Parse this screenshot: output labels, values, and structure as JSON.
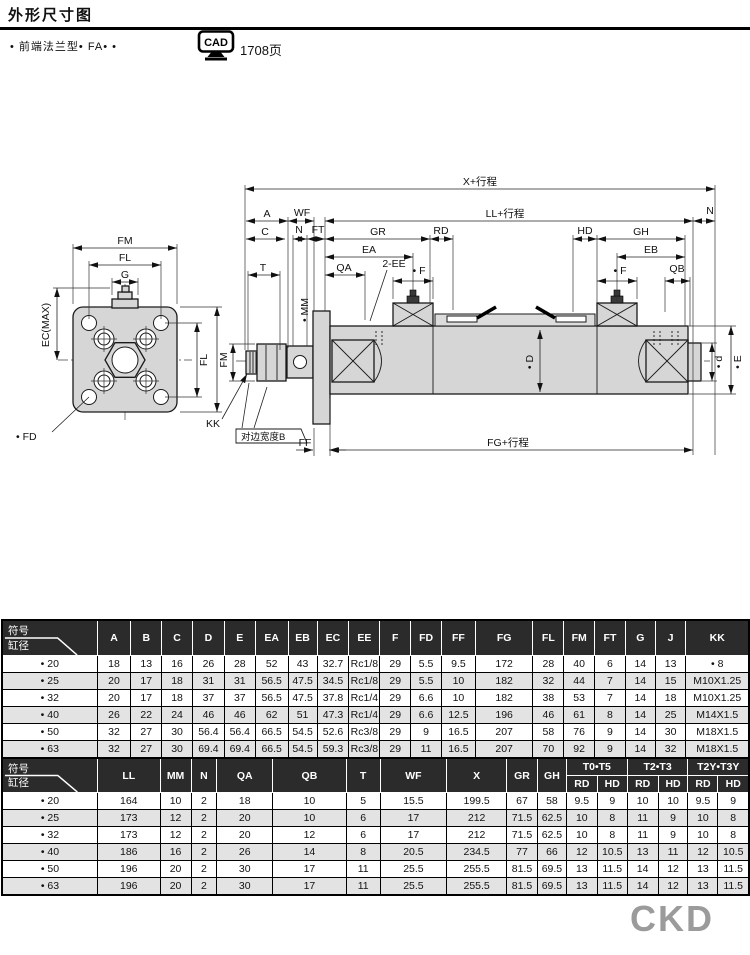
{
  "page": {
    "title": "外形尺寸图",
    "subtitle": "•  前端法兰型•  FA•  •",
    "cad_icon_label": "CAD",
    "cad_page": "1708页",
    "brand": "CKD",
    "colors": {
      "header_bg": "#2b2b2b",
      "row_alt": "#e3e3e3",
      "brand_gray": "#9b9b9b",
      "metal_fill": "#d6d6d6"
    }
  },
  "drawing": {
    "labels": {
      "x_stroke": "X+行程",
      "a": "A",
      "wf": "WF",
      "ll_stroke": "LL+行程",
      "n_right": "N",
      "c": "C",
      "n_mid": "N",
      "ft": "FT",
      "gr": "GR",
      "rd": "RD",
      "hd": "HD",
      "gh": "GH",
      "ea": "EA",
      "eb": "EB",
      "t": "T",
      "qa": "QA",
      "ee": "2-EE",
      "f_front": "• F",
      "f_rear": "• F",
      "qb": "QB",
      "fm_h": "FM",
      "fl_h": "FL",
      "g": "G",
      "ec_max": "EC(MAX)",
      "fl_v": "FL",
      "fm_v": "FM",
      "fd": "• FD",
      "kk": "KK",
      "mm": "• MM",
      "d_bore": "• D",
      "d_rod": "• d",
      "e_dim": "• E",
      "flat_b": "对边宽度B",
      "ff": "FF",
      "fg_stroke": "FG+行程"
    }
  },
  "tables": [
    {
      "corner_top": "符号",
      "corner_bottom": "缸径",
      "columns": [
        "A",
        "B",
        "C",
        "D",
        "E",
        "EA",
        "EB",
        "EC",
        "EE",
        "F",
        "FD",
        "FF",
        "FG",
        "FL",
        "FM",
        "FT",
        "G",
        "J",
        "KK"
      ],
      "rows": [
        {
          "bore": "• 20",
          "cells": [
            "18",
            "13",
            "16",
            "26",
            "28",
            "52",
            "43",
            "32.7",
            "Rc1/8",
            "29",
            "5.5",
            "9.5",
            "172",
            "28",
            "40",
            "6",
            "14",
            "13",
            "• 8"
          ]
        },
        {
          "bore": "• 25",
          "cells": [
            "20",
            "17",
            "18",
            "31",
            "31",
            "56.5",
            "47.5",
            "34.5",
            "Rc1/8",
            "29",
            "5.5",
            "10",
            "182",
            "32",
            "44",
            "7",
            "14",
            "15",
            "M10X1.25"
          ]
        },
        {
          "bore": "• 32",
          "cells": [
            "20",
            "17",
            "18",
            "37",
            "37",
            "56.5",
            "47.5",
            "37.8",
            "Rc1/4",
            "29",
            "6.6",
            "10",
            "182",
            "38",
            "53",
            "7",
            "14",
            "18",
            "M10X1.25"
          ]
        },
        {
          "bore": "• 40",
          "cells": [
            "26",
            "22",
            "24",
            "46",
            "46",
            "62",
            "51",
            "47.3",
            "Rc1/4",
            "29",
            "6.6",
            "12.5",
            "196",
            "46",
            "61",
            "8",
            "14",
            "25",
            "M14X1.5"
          ]
        },
        {
          "bore": "• 50",
          "cells": [
            "32",
            "27",
            "30",
            "56.4",
            "56.4",
            "66.5",
            "54.5",
            "52.6",
            "Rc3/8",
            "29",
            "9",
            "16.5",
            "207",
            "58",
            "76",
            "9",
            "14",
            "30",
            "M18X1.5"
          ]
        },
        {
          "bore": "• 63",
          "cells": [
            "32",
            "27",
            "30",
            "69.4",
            "69.4",
            "66.5",
            "54.5",
            "59.3",
            "Rc3/8",
            "29",
            "11",
            "16.5",
            "207",
            "70",
            "92",
            "9",
            "14",
            "32",
            "M18X1.5"
          ]
        }
      ]
    },
    {
      "corner_top": "符号",
      "corner_bottom": "缸径",
      "columns": [
        "LL",
        "MM",
        "N",
        "QA",
        "QB",
        "T",
        "WF",
        "X",
        "GR",
        "GH"
      ],
      "groups": [
        {
          "label": "T0•T5",
          "sub": [
            "RD",
            "HD"
          ]
        },
        {
          "label": "T2•T3",
          "sub": [
            "RD",
            "HD"
          ]
        },
        {
          "label": "T2Y•T3Y",
          "sub": [
            "RD",
            "HD"
          ]
        }
      ],
      "rows": [
        {
          "bore": "• 20",
          "cells": [
            "164",
            "10",
            "2",
            "18",
            "10",
            "5",
            "15.5",
            "199.5",
            "67",
            "58",
            "9.5",
            "9",
            "10",
            "10",
            "9.5",
            "9"
          ]
        },
        {
          "bore": "• 25",
          "cells": [
            "173",
            "12",
            "2",
            "20",
            "10",
            "6",
            "17",
            "212",
            "71.5",
            "62.5",
            "10",
            "8",
            "11",
            "9",
            "10",
            "8"
          ]
        },
        {
          "bore": "• 32",
          "cells": [
            "173",
            "12",
            "2",
            "20",
            "12",
            "6",
            "17",
            "212",
            "71.5",
            "62.5",
            "10",
            "8",
            "11",
            "9",
            "10",
            "8"
          ]
        },
        {
          "bore": "• 40",
          "cells": [
            "186",
            "16",
            "2",
            "26",
            "14",
            "8",
            "20.5",
            "234.5",
            "77",
            "66",
            "12",
            "10.5",
            "13",
            "11",
            "12",
            "10.5"
          ]
        },
        {
          "bore": "• 50",
          "cells": [
            "196",
            "20",
            "2",
            "30",
            "17",
            "11",
            "25.5",
            "255.5",
            "81.5",
            "69.5",
            "13",
            "11.5",
            "14",
            "12",
            "13",
            "11.5"
          ]
        },
        {
          "bore": "• 63",
          "cells": [
            "196",
            "20",
            "2",
            "30",
            "17",
            "11",
            "25.5",
            "255.5",
            "81.5",
            "69.5",
            "13",
            "11.5",
            "14",
            "12",
            "13",
            "11.5"
          ]
        }
      ]
    }
  ]
}
